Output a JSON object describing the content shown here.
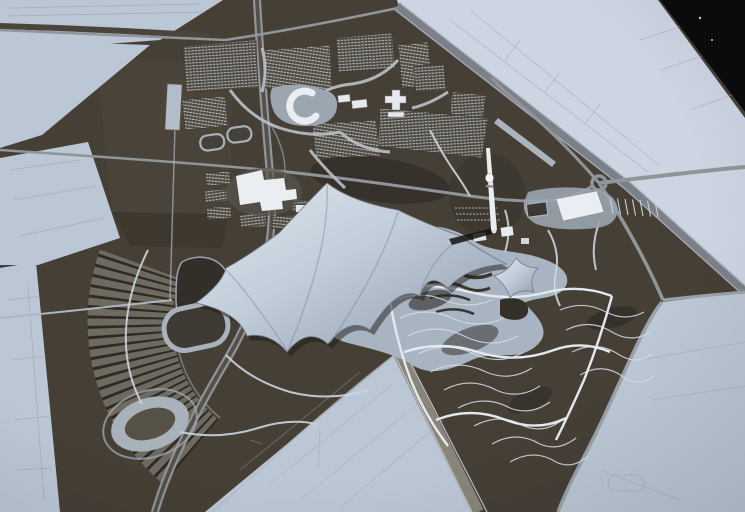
{
  "meta": {
    "type": "photograph",
    "subject": "Aerial photograph of an architectural scale model of the Munich Olympic Park (Olympiapark) with tent roofs, stadium, tower, Olympic village and landscaped hills",
    "style": "high-contrast slide photo, pale blue-grey city fabric, dark olive parkland"
  },
  "palette": {
    "city_light": "#bcc7d5",
    "city_light_warm": "#cdd4e2",
    "park_dark": "#453f36",
    "park_deep": "#2e2a24",
    "field_brown": "#4a4339",
    "road_gray": "#8f9598",
    "corridor_gray": "#7b8089",
    "path_light": "#d3dbe2",
    "tent_light": "#d8e0e9",
    "tent_shade": "#94a0b1",
    "concrete_white": "#eaeef2",
    "ring_gray": "#a7b0b8",
    "contour_light": "#d6dde5",
    "lake_gray": "#a9b4c2",
    "block_base": "#4d4840",
    "block_dot": "#bcc3c7",
    "film_black": "#0b0b0e",
    "shadow_black": "#1d1a16"
  },
  "scene": {
    "landmarks": [
      {
        "name": "tent-roof",
        "desc": "large spiky silver membrane canopy over stadium, sports hall and pool"
      },
      {
        "name": "olympic-stadium-bowl",
        "desc": "sunken bowl with concentric seating rings"
      },
      {
        "name": "olympic-tower",
        "desc": "tall white needle tower with observation knob, casts shadow"
      },
      {
        "name": "olympic-village",
        "desc": "dense gridded housing blocks, top centre"
      },
      {
        "name": "crescent-building",
        "desc": "white C-shaped building on plaza"
      },
      {
        "name": "cross-building",
        "desc": "white cross-shaped building cluster"
      },
      {
        "name": "running-track",
        "desc": "rounded-rectangle athletics track"
      },
      {
        "name": "velodrome-oval",
        "desc": "oval cycling track, lower left"
      },
      {
        "name": "parking-fan",
        "desc": "radially striped fan-shaped parking terraces west of stadium"
      },
      {
        "name": "olympiaberg-hills",
        "desc": "contoured landscape hills with white footpaths, lower right"
      },
      {
        "name": "lake-plaza",
        "desc": "pale lake and terraces south-east of the tent"
      },
      {
        "name": "highway",
        "desc": "twin-carriage motorway curving down the left side"
      },
      {
        "name": "rail-corridor",
        "desc": "straight grey rail/road corridor separating park from city grid"
      },
      {
        "name": "roundabout",
        "desc": "circular traffic junction east of the tower"
      },
      {
        "name": "ice-rink",
        "desc": "bright white rectangular hall with parking rows"
      },
      {
        "name": "film-corner",
        "desc": "black clipped corner of the slide, top right"
      }
    ]
  }
}
